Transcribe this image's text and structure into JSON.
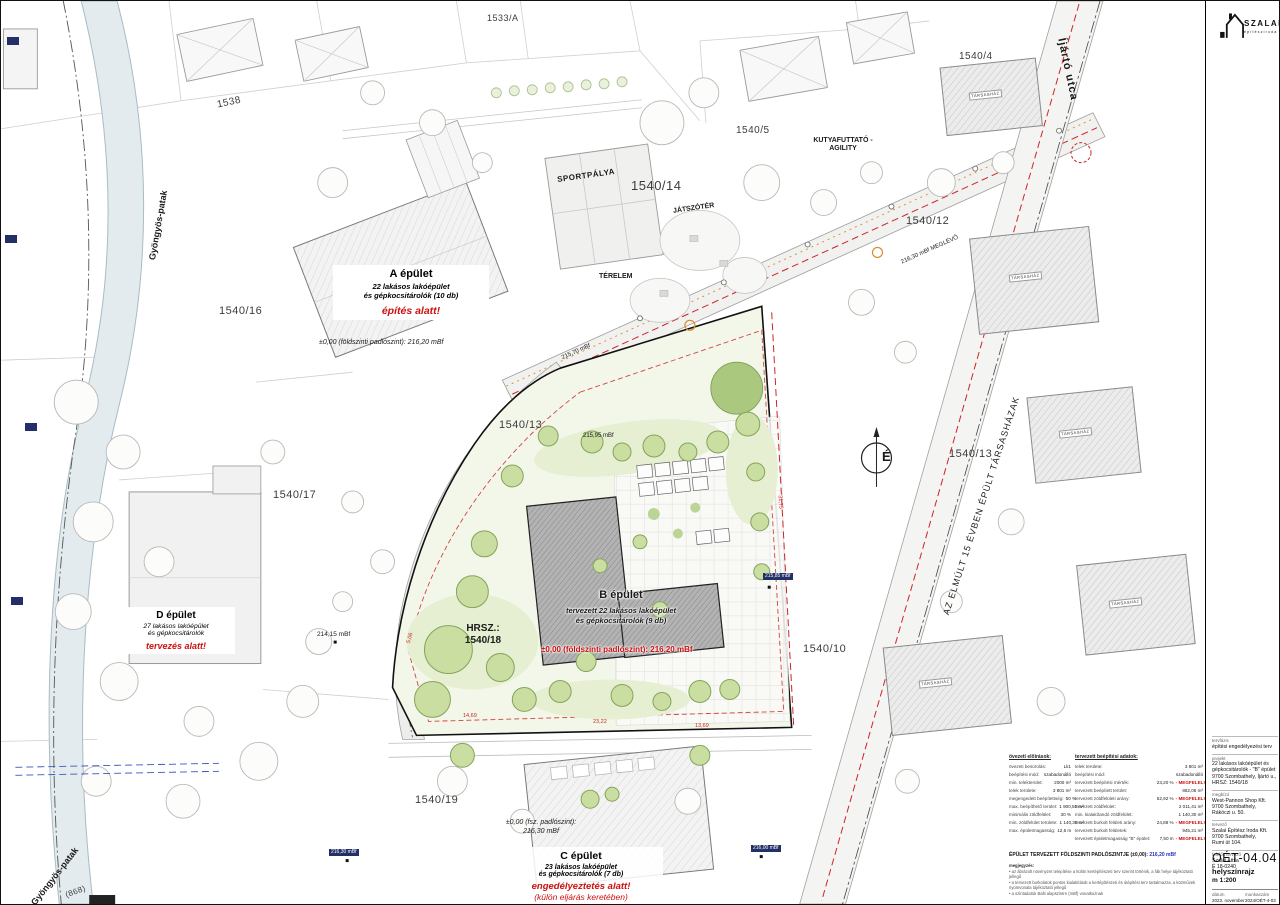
{
  "sheet": {
    "logo": {
      "name": "SZALAI",
      "subtitle": "építésziroda"
    },
    "titleblock": {
      "tervfazis_label": "tervfázis",
      "tervfazis": "építési engedélyezési terv",
      "projekt_label": "projekt",
      "projekt_lines": [
        "22 lakásos lakóépület és",
        "gépkocsitárolók - \"B\" épület",
        "9700 Szombathely, Íjártó u.,",
        "HRSZ: 1540/18"
      ],
      "megbizo_label": "megbízó",
      "megbizo_lines": [
        "West-Pannon Shop Kft.",
        "9700 Szombathely,",
        "Rákóczi u. 50."
      ],
      "tervezo_label": "tervező",
      "tervezo_lines": [
        "Szalai Építész Iroda Kft.",
        "9700 Szombathely,",
        "Rumi út 104."
      ],
      "felelos_label": "felelős tervező",
      "felelos_lines": [
        "Szalai Attila",
        "É 18-0240"
      ],
      "sheet_code": "OÉT-04.04",
      "sheet_name": "helyszínrajz",
      "scale": "m 1:200",
      "datum_label": "dátum",
      "datum_value": "2023. november",
      "munkaszam_label": "munkaszám",
      "munkaszam_value": "2024/OÉT-4-03"
    }
  },
  "map": {
    "north_label": "É",
    "site_hrsz": [
      "HRSZ.:",
      "1540/18"
    ],
    "streets": {
      "ijarto": "Íjártó utca",
      "gyongyos_top": "Gyöngyös-patak",
      "gyongyos_bottom": "Gyöngyös-patak",
      "creek_hrsz": "(868)",
      "diagonal_note": "AZ ELMÚLT 15 ÉVBEN ÉPÜLT TÁRSASHÁZAK"
    },
    "plots": {
      "p1533a": "1533/A",
      "p1538": "1538",
      "p1540_4": "1540/4",
      "p1540_5": "1540/5",
      "p1540_12": "1540/12",
      "p1540_14": "1540/14",
      "p1540_16": "1540/16",
      "p1540_13_left": "1540/13",
      "p1540_13_right": "1540/13",
      "p1540_17": "1540/17",
      "p1540_10": "1540/10",
      "p1540_19": "1540/19"
    },
    "areas": {
      "sport": "SPORTPÁLYA",
      "playground": "JÁTSZÓTÉR",
      "terelem": "TÉRELEM",
      "dog_run": "KUTYAFUTTATÓ - AGILITY",
      "tarsashaz": "TÁRSASHÁZ"
    },
    "levels": {
      "meglevo": "216,30 mBf MEGLÉVŐ",
      "l215_70": "215,70 mBf",
      "l215_95": "215,95 mBf",
      "l214_15": "214,15 mBf",
      "l215_85": "215,85 mBf",
      "l216_00": "216,00 mBf",
      "l216_30": "216,30 mBf"
    },
    "dims": {
      "d1": "5,06",
      "d2": "14,69",
      "d3": "23,22",
      "d4": "13,69",
      "d5": "31,75"
    }
  },
  "buildings": {
    "a": {
      "title": "A épület",
      "desc1": "22 lakásos lakóépület",
      "desc2": "és gépkocsitárolók (10 db)",
      "status": "építés alatt!",
      "level": "±0,00 (földszinti padlószint): 216,20 mBf"
    },
    "b": {
      "title": "B épület",
      "desc1": "tervezett 22 lakásos lakóépület",
      "desc2": "és gépkocsitárolók (9 db)",
      "level": "±0,00 (földszinti padlószint): 216,20 mBf"
    },
    "c": {
      "title": "C épület",
      "desc1": "23 lakásos lakóépület",
      "desc2": "és gépkocsitárolók (7 db)",
      "status": "engedélyeztetés alatt!",
      "status_note": "(külön eljárás keretében)",
      "level1": "±0,00 (fsz. padlószint):",
      "level2": "216,30 mBf"
    },
    "d": {
      "title": "D épület",
      "desc1": "27 lakásos lakóépület",
      "desc2": "és gépkocsitárolók",
      "status": "tervezés alatt!"
    }
  },
  "table": {
    "left_header": "övezeti előírások:",
    "left_rows": [
      {
        "label": "övezeti besorolás:",
        "value": "Lk1"
      },
      {
        "label": "beépítési mód:",
        "value": "szabadonálló"
      },
      {
        "label": "min. telekterület:",
        "value": "2000 m²"
      },
      {
        "label": "telek területe:",
        "value": "3 801 m²"
      },
      {
        "label": "megengedett beépítettség:",
        "value": "50 %"
      },
      {
        "label": "max. beépíthető terület:",
        "value": "1 900,50 m²"
      },
      {
        "label": "minimális zöldfelület:",
        "value": "30 %"
      },
      {
        "label": "min. zöldfelület területe:",
        "value": "1 140,30 m²"
      },
      {
        "label": "max. épületmagasság:",
        "value": "12,5 m"
      }
    ],
    "right_header": "tervezett beépítési adatok:",
    "right_rows": [
      {
        "label": "telek területe:",
        "value": "3 801 m²",
        "ok": ""
      },
      {
        "label": "beépítési mód:",
        "value": "szabadonálló",
        "ok": ""
      },
      {
        "label": "tervezett beépítési mérték:",
        "value": "23,20 %",
        "ok": "- MEGFELEL!"
      },
      {
        "label": "tervezett beépített terület:",
        "value": "882,06 m²",
        "ok": ""
      },
      {
        "label": "tervezett zöldfelületi arány:",
        "value": "52,92 %",
        "ok": "- MEGFELEL!"
      },
      {
        "label": "tervezett zöldfelület:",
        "value": "2 011,41 m²",
        "ok": ""
      },
      {
        "label": "min. kialakítandó zöldfelület:",
        "value": "1 140,30 m²",
        "ok": ""
      },
      {
        "label": "tervezett burkolt felületi arány:",
        "value": "24,88 %",
        "ok": "- MEGFELEL!"
      },
      {
        "label": "tervezett burkolt felületek:",
        "value": "945,21 m²",
        "ok": ""
      },
      {
        "label": "tervezett épületmagasság \"B\" épület:",
        "value": "7,50 m",
        "ok": "- MEGFELEL!"
      }
    ]
  },
  "notes": {
    "band_label": "ÉPÜLET TERVEZETT FÖLDSZINTI PADLÓSZINTJE (±0,00):",
    "band_value": "216,20 mBf",
    "megjegyzes_label": "megjegyzés:",
    "items": [
      "• az ábrázolt növényzet telepítése a külön kertépítészeti terv szerint történik, a fák helye tájékoztató jellegű",
      "• a tervezett burkolatok pontos kialakítását a kertépítészeti és útépítési terv tartalmazza, a közművek nyomvonala tájékoztató jellegű",
      "• a szintadatok Balti alapszintre (mBf) vonatkoznak"
    ]
  }
}
